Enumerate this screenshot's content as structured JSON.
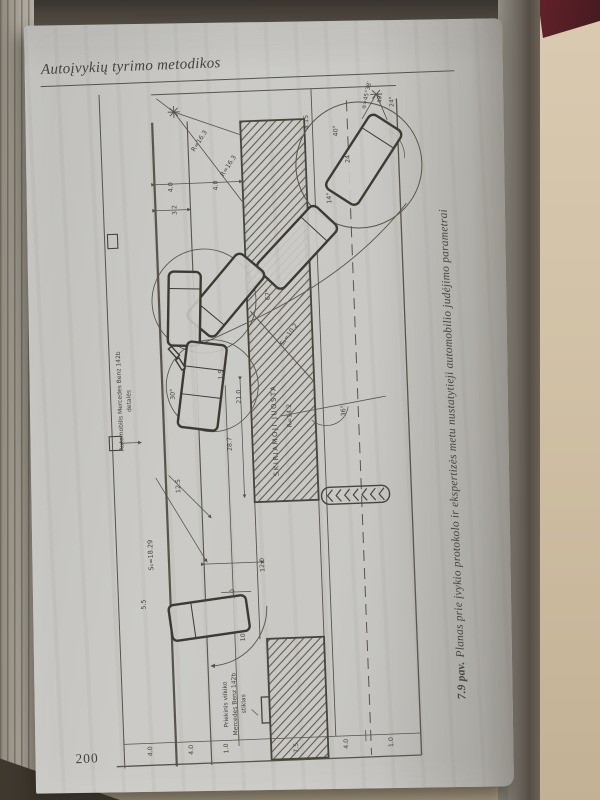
{
  "page": {
    "header": "Autoįvykių tyrimo metodikos",
    "page_number": "200",
    "caption_lead": "7.9 pav.",
    "caption_text": "Planas prie įvykio protokolo ir ekspertizės metu nustatytieji automobilio judėjimo parametrai"
  },
  "diagram": {
    "chevron_count": 7,
    "labels": [
      {
        "t": "Automobilis Mercedes Benz 142b",
        "x": 26,
        "y": 317,
        "r": -90,
        "s": 6
      },
      {
        "t": "detalės",
        "x": 35,
        "y": 317,
        "r": -90,
        "s": 6
      },
      {
        "t": "SKIRIAMOJI JUOSTA",
        "x": 180,
        "y": 352,
        "r": -90,
        "s": 6.8,
        "ls": 1.6
      },
      {
        "t": "S₁=18.29",
        "x": 51,
        "y": 472,
        "r": -90,
        "s": 6.5
      },
      {
        "t": "12.5",
        "x": 81,
        "y": 404,
        "r": -90
      },
      {
        "t": "5.5",
        "x": 42,
        "y": 521,
        "r": -90
      },
      {
        "t": "1.0",
        "x": 131,
        "y": 514,
        "r": -90
      },
      {
        "t": "12.0",
        "x": 162,
        "y": 486,
        "r": -90
      },
      {
        "t": "21.0",
        "x": 145,
        "y": 317,
        "r": -90
      },
      {
        "t": "28.7",
        "x": 134,
        "y": 364,
        "r": -90
      },
      {
        "t": "1.9",
        "x": 128,
        "y": 294,
        "r": -90
      },
      {
        "t": "30°",
        "x": 79,
        "y": 312,
        "r": -90
      },
      {
        "t": "3.2",
        "x": 88,
        "y": 128,
        "r": -90
      },
      {
        "t": "4.0",
        "x": 85,
        "y": 105,
        "r": -90
      },
      {
        "t": "4.0",
        "x": 130,
        "y": 105,
        "r": -90
      },
      {
        "t": "R=16.3",
        "x": 115,
        "y": 61,
        "r": -55
      },
      {
        "t": "R=16.3",
        "x": 143,
        "y": 87,
        "r": -55
      },
      {
        "t": "α=45°38′",
        "x": 284,
        "y": 21,
        "r": -75,
        "s": 5.8
      },
      {
        "t": "40°",
        "x": 297,
        "y": 24,
        "r": -90,
        "s": 5.8
      },
      {
        "t": "24°",
        "x": 309,
        "y": 28,
        "r": -90,
        "s": 5.8
      },
      {
        "t": "40°",
        "x": 252,
        "y": 55,
        "r": -90
      },
      {
        "t": "24°",
        "x": 263,
        "y": 82,
        "r": -90
      },
      {
        "t": "4.15",
        "x": 223,
        "y": 45,
        "r": -90
      },
      {
        "t": "14°",
        "x": 243,
        "y": 122,
        "r": -90
      },
      {
        "t": "67°",
        "x": 178,
        "y": 216,
        "r": -90
      },
      {
        "t": "R=14.2",
        "x": 195,
        "y": 338,
        "r": -90
      },
      {
        "t": "36°",
        "x": 249,
        "y": 335,
        "r": -90
      },
      {
        "t": "S₂=10.2",
        "x": 197,
        "y": 258,
        "r": -52
      },
      {
        "t": "10°",
        "x": 140,
        "y": 556,
        "r": -90
      },
      {
        "t": "Priekinis vilkiko",
        "x": 120,
        "y": 624,
        "r": -90,
        "s": 6
      },
      {
        "t": "Mercedes Benz 142b",
        "x": 129,
        "y": 624,
        "r": -90,
        "s": 6
      },
      {
        "t": "stiklas",
        "x": 138,
        "y": 624,
        "r": -90,
        "s": 6
      },
      {
        "t": "4.0",
        "x": 43,
        "y": 668,
        "r": -90
      },
      {
        "t": "4.0",
        "x": 84,
        "y": 668,
        "r": -90
      },
      {
        "t": "1.0",
        "x": 119,
        "y": 668,
        "r": -90
      },
      {
        "t": "7.5",
        "x": 189,
        "y": 670,
        "r": -90
      },
      {
        "t": "4.0",
        "x": 239,
        "y": 668,
        "r": -90
      },
      {
        "t": "1.0",
        "x": 284,
        "y": 668,
        "r": -90
      }
    ]
  },
  "colors": {
    "page": "#c9c8c4",
    "ink": "#45433d",
    "line": "#57544c",
    "vehicle_stroke": "#3c3a33",
    "book_cover": "#5a2028",
    "desk": "#d2c2a7"
  }
}
